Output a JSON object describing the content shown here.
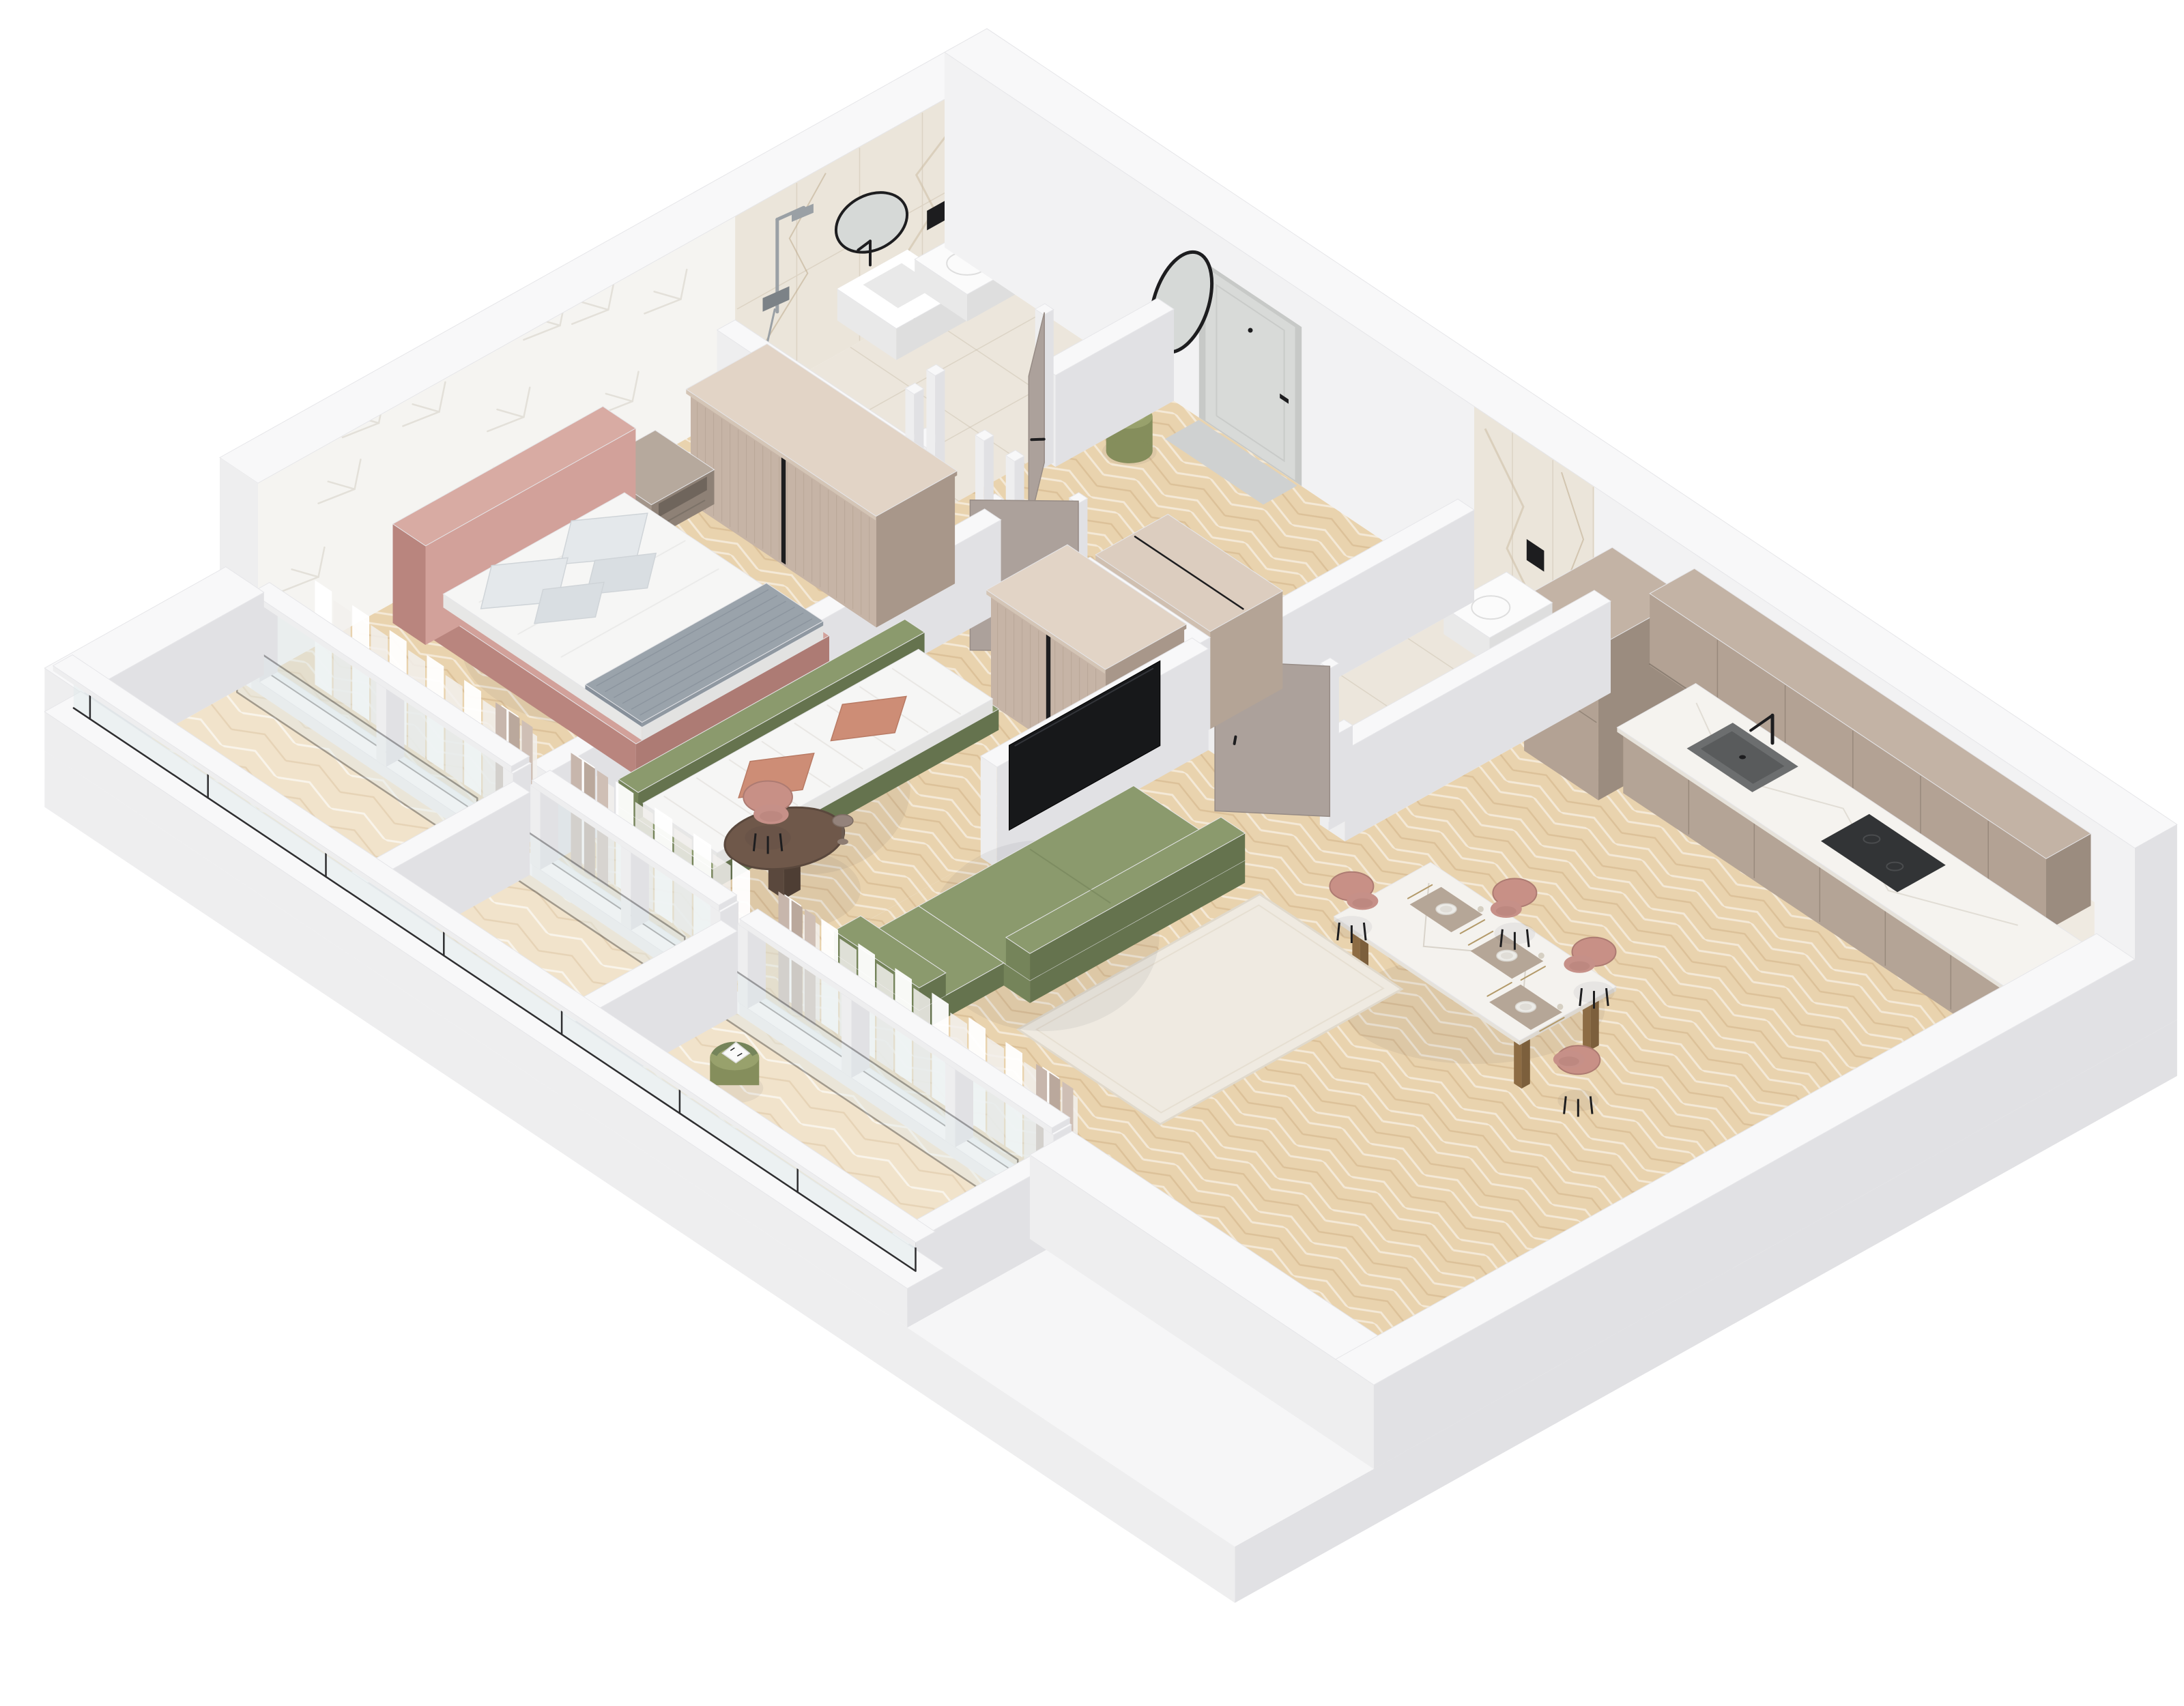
{
  "scene": {
    "title": "isometric-apartment-floor-plan-render",
    "style": "3d cutaway axonometric rendering, no text labels",
    "rooms": [
      {
        "id": "bathroom",
        "label": "Bathroom with shower"
      },
      {
        "id": "hall",
        "label": "Entry hall"
      },
      {
        "id": "powder-room",
        "label": "Guest WC"
      },
      {
        "id": "bedroom",
        "label": "Bedroom"
      },
      {
        "id": "kids-room",
        "label": "Kids room / second bedroom"
      },
      {
        "id": "kitchen-living",
        "label": "Kitchen-living room"
      },
      {
        "id": "balcony",
        "label": "Balconies"
      }
    ]
  },
  "palette": {
    "base_top": "#f6f6f7",
    "white_top": "#f8f8f9",
    "white_face": "#eeeeef",
    "white_side": "#e1e1e4",
    "white_dark": "#d7d7da",
    "edge": "#e6e6e9",
    "tile": "#ece6dc",
    "tile_line": "rgba(195,184,162,0.38)",
    "wallpaper": "#f5f4f1",
    "motif": "#e3e0d9",
    "marble": "#ebe5da",
    "vein1": "#cfc0a8",
    "vein2": "#b9a585",
    "seam": "#dcd3c4",
    "taupe_top": "#dccdbf",
    "taupe_front": "#c6b4a6",
    "taupe_side": "#a8978a",
    "flute": "#b3a192",
    "cab_top": "#c3b3a5",
    "cab_front": "#b3a294",
    "cab_side": "#9b8c7f",
    "cab_base": "#b4a496",
    "counter_top": "#f5f3ef",
    "counter_edge": "#e6e2da",
    "sink": "#6c6e6f",
    "sink_dark": "#595b5c",
    "appliance": "#323436",
    "door": "#aca19b",
    "door_dark": "#968b85",
    "entry": "#d8dad8",
    "entry_frame": "#c7c9c7",
    "black": "#1d1d1f",
    "chrome": "#9aa0a5",
    "pink": "#d2a19a",
    "pink_dark": "#b9857e",
    "pink_mid": "#c69088",
    "white_fab": "#f6f6f5",
    "fab_shadow": "#e7e7e6",
    "pillow": "#e4e8eb",
    "pillow2": "#d9dee2",
    "throw": "#9aa3ab",
    "throw_dark": "#87909a",
    "green": "#8b9a6d",
    "green_dark": "#75845a",
    "green_deep": "#65734e",
    "terra": "#cd8d76",
    "terra_dark": "#b87a64",
    "rug": "#efeae1",
    "rug_edge": "#e0d9cc",
    "night_top": "#b6a99d",
    "night_front": "#a2958a",
    "night_side": "#8e8176",
    "marbleT": "#f4f2ee",
    "leg": "#a07c52",
    "chair": "#c89086",
    "chair_dark": "#ad7b72",
    "desk": "#6f584a",
    "desk_dark": "#5a483d",
    "mirror": "#d6d9d7",
    "glass": "#e0eaec",
    "glass_dark": "#2e2e30",
    "pouf": "#98a16c",
    "pouf_dark": "#858e5c",
    "curtain": "#ffffff",
    "curtain2": "#f2f0ed",
    "drape1": "#c7b6ac",
    "drape2": "#baa89c",
    "drape3": "#cfbfb5",
    "tv": "#17181a",
    "fix": "#fbfbfb",
    "fix_sh": "#e9e9e9",
    "fix_sh2": "#dedede",
    "wood_base": "#e9d3ae",
    "wood_hi": "rgba(255,255,255,0.5)",
    "wood_lo": "rgba(186,148,98,0.28)",
    "woodL_base": "#f1e3cb"
  },
  "projection": {
    "ox": 1440,
    "oy": 400,
    "ex": [
      160,
      107
    ],
    "ey": [
      -177,
      99
    ],
    "zs": 110
  },
  "items": [
    {
      "t": "base",
      "n": "building-base",
      "r": [
        -0.35,
        -0.35,
        10.55,
        7.45
      ],
      "z": [
        -0.75,
        0
      ]
    },
    {
      "t": "floor",
      "n": "kitchen-living-floor",
      "pts": [
        [
          5.75,
          0
        ],
        [
          10.2,
          0
        ],
        [
          10.2,
          5.95
        ],
        [
          4.35,
          5.95
        ],
        [
          4.35,
          2.2
        ],
        [
          4.5,
          2.2
        ],
        [
          4.5,
          2.0
        ],
        [
          5.75,
          2.0
        ]
      ],
      "f": "wood"
    },
    {
      "t": "floor",
      "n": "bathroom-floor",
      "r": [
        0,
        0,
        1.6,
        2.05
      ],
      "f": "tile"
    },
    {
      "t": "floor",
      "n": "hall-floor",
      "r": [
        1.6,
        0,
        4.35,
        2.2
      ],
      "f": "wood"
    },
    {
      "t": "floor",
      "n": "powder-room-floor",
      "r": [
        4.5,
        0,
        5.6,
        2.0
      ],
      "f": "tile"
    },
    {
      "t": "floor",
      "n": "bedroom-floor",
      "r": [
        0,
        2.05,
        2.45,
        5.95
      ],
      "f": "wood"
    },
    {
      "t": "floor",
      "n": "kids-room-floor",
      "r": [
        2.45,
        2.05,
        4.35,
        5.95
      ],
      "f": "wood"
    },
    {
      "t": "floor",
      "n": "balcony-floor",
      "r": [
        0,
        6.1,
        7.4,
        7.15
      ],
      "f": "woodL"
    },
    {
      "t": "westwall",
      "n": "west-wall"
    },
    {
      "t": "shower",
      "n": "shower-set",
      "y": 1.72
    },
    {
      "t": "roundmirror",
      "n": "bathroom-round-mirror",
      "cy": 0.93,
      "cz": 1.52,
      "r": 0.3
    },
    {
      "t": "vanity",
      "n": "bathroom-vanity"
    },
    {
      "t": "toiletW",
      "n": "bathroom-toilet"
    },
    {
      "t": "northwall",
      "n": "north-wall"
    },
    {
      "t": "pouf",
      "n": "hall-pouf",
      "cx": 1.95,
      "cy": 0.55
    },
    {
      "t": "box",
      "n": "kitchen-tall-cabinet",
      "r": [
        5.82,
        0.05,
        6.5,
        0.78
      ],
      "z": [
        0,
        2.05
      ],
      "c": [
        "cab_top",
        "cab_front",
        "cab_side"
      ],
      "hseams": [
        1.02,
        1.7
      ]
    },
    {
      "t": "uppers",
      "n": "kitchen-upper-cabinets",
      "r": [
        6.55,
        0.03,
        10.18,
        0.4
      ],
      "z": [
        1.5,
        2.46
      ]
    },
    {
      "t": "counter",
      "n": "kitchen-counter",
      "r": [
        6.55,
        0.02,
        10.18,
        0.62
      ]
    },
    {
      "t": "sink",
      "n": "kitchen-sink",
      "r": [
        7.0,
        0.12,
        7.6,
        0.5
      ]
    },
    {
      "t": "cooktop",
      "n": "kitchen-cooktop",
      "r": [
        8.25,
        0.12,
        8.95,
        0.52
      ]
    },
    {
      "t": "toiletN",
      "n": "powder-room-toilet",
      "x0": 4.84,
      "x1": 5.26
    },
    {
      "t": "wall",
      "n": "bathroom-hall-wall-a",
      "r": [
        1.6,
        0,
        1.75,
        0.98
      ],
      "h": 1.22
    },
    {
      "t": "wall",
      "n": "bathroom-hall-wall-b",
      "r": [
        1.6,
        1.92,
        1.75,
        2.05
      ],
      "h": 1.22
    },
    {
      "t": "door",
      "n": "bathroom-door",
      "hx": 1.67,
      "hy": 1.0,
      "ex": 2.08,
      "ey": 1.5,
      "fx": 1.67,
      "fy": 1.9
    },
    {
      "t": "wall",
      "n": "powder-west-wall",
      "r": [
        4.35,
        0,
        4.5,
        2.2
      ],
      "h": 1.22
    },
    {
      "t": "wall",
      "n": "powder-east-wall",
      "r": [
        5.6,
        0,
        5.75,
        2.2
      ],
      "h": 1.22
    },
    {
      "t": "wall",
      "n": "powder-south-wall-a",
      "r": [
        4.5,
        2.0,
        4.62,
        2.2
      ],
      "h": 1.22
    },
    {
      "t": "wall",
      "n": "powder-south-wall-b",
      "r": [
        5.52,
        2.0,
        5.6,
        2.2
      ],
      "h": 1.22
    },
    {
      "t": "door",
      "n": "powder-room-door",
      "hx": 5.5,
      "hy": 2.1,
      "ex": 4.98,
      "ey": 2.58,
      "fx": 4.66,
      "fy": 2.1
    },
    {
      "t": "closet",
      "n": "hall-closet",
      "r": [
        3.3,
        1.45,
        4.35,
        2.05
      ],
      "h": 1.3
    },
    {
      "t": "wall",
      "n": "bedroom-north-wall-a",
      "r": [
        0,
        2.05,
        1.7,
        2.2
      ],
      "h": 1.22
    },
    {
      "t": "wall",
      "n": "bedroom-north-wall-b",
      "r": [
        2.38,
        2.05,
        2.45,
        2.2
      ],
      "h": 1.22
    },
    {
      "t": "posts",
      "n": "bedroom-door-frame",
      "pp": [
        [
          1.72,
          2.12
        ],
        [
          2.36,
          2.12
        ]
      ]
    },
    {
      "t": "wall",
      "n": "kids-north-wall-a",
      "r": [
        2.45,
        2.05,
        2.62,
        2.2
      ],
      "h": 1.22
    },
    {
      "t": "wall",
      "n": "kids-north-wall-b",
      "r": [
        3.25,
        2.05,
        4.35,
        2.2
      ],
      "h": 1.22
    },
    {
      "t": "door",
      "n": "kids-room-door",
      "hx": 3.22,
      "hy": 2.12,
      "ex": 2.76,
      "ey": 2.6,
      "fx": 2.64,
      "fy": 2.12
    },
    {
      "t": "wall",
      "n": "bedroom-kids-wall",
      "r": [
        2.45,
        2.2,
        2.6,
        5.95
      ],
      "h": 1.22
    },
    {
      "t": "wardrobe",
      "n": "bedroom-wardrobe",
      "r": [
        0.5,
        2.22,
        2.2,
        2.87
      ],
      "h": 1.52
    },
    {
      "t": "nightstand",
      "n": "bedroom-nightstand",
      "r": [
        0.12,
        2.82,
        0.66,
        3.34
      ]
    },
    {
      "t": "bed",
      "n": "bed"
    },
    {
      "t": "wardrobe",
      "n": "kids-wardrobe",
      "r": [
        3.25,
        2.22,
        4.3,
        2.87
      ],
      "h": 1.52
    },
    {
      "t": "kidsbed",
      "n": "kids-bed"
    },
    {
      "t": "tvwall",
      "n": "tv-wall"
    },
    {
      "t": "dining",
      "n": "dining-set"
    },
    {
      "t": "rug",
      "n": "living-room-rug",
      "r": [
        5.8,
        2.95,
        7.1,
        4.95
      ]
    },
    {
      "t": "sofa",
      "n": "sofa"
    },
    {
      "t": "desk",
      "n": "kids-desk-set"
    },
    {
      "t": "curtains",
      "n": "bedroom-curtains",
      "x0": 0.3,
      "x1": 2.35,
      "drape": "right"
    },
    {
      "t": "curtains",
      "n": "kids-room-curtains",
      "x0": 2.7,
      "x1": 4.3,
      "drape": "left"
    },
    {
      "t": "curtains",
      "n": "living-room-curtains",
      "x0": 4.6,
      "x1": 7.3,
      "drape": "both"
    },
    {
      "t": "windows",
      "n": "bedroom-windows",
      "x0": 0.08,
      "x1": 2.4,
      "mids": [
        1.24
      ]
    },
    {
      "t": "windows",
      "n": "kids-room-windows",
      "x0": 2.65,
      "x1": 4.3,
      "mids": [
        3.48
      ]
    },
    {
      "t": "windows",
      "n": "living-room-windows",
      "x0": 4.55,
      "x1": 7.35,
      "mids": [
        5.5,
        6.45
      ]
    },
    {
      "t": "wall",
      "n": "balcony-west-wall",
      "r": [
        -0.35,
        5.95,
        0,
        7.45
      ],
      "h": 1.1
    },
    {
      "t": "wall",
      "n": "balcony-divider-1",
      "r": [
        2.45,
        6.1,
        2.6,
        7.45
      ],
      "h": 1.1
    },
    {
      "t": "wall",
      "n": "balcony-divider-2",
      "r": [
        4.35,
        6.1,
        4.5,
        7.45
      ],
      "h": 1.1
    },
    {
      "t": "balconychair",
      "n": "balcony-lounge-chair",
      "cx": 5.05,
      "cy": 6.62
    },
    {
      "t": "wall",
      "n": "balcony-east-wall",
      "r": [
        7.4,
        6.1,
        7.55,
        7.45
      ],
      "h": 1.1
    },
    {
      "t": "parapet",
      "n": "balcony-parapet"
    },
    {
      "t": "wall",
      "n": "south-east-wall",
      "r": [
        7.4,
        5.95,
        10.55,
        6.3
      ],
      "h": 1.12
    },
    {
      "t": "wall",
      "n": "east-wall",
      "r": [
        10.2,
        0,
        10.55,
        6.3
      ],
      "h": 1.12
    }
  ]
}
